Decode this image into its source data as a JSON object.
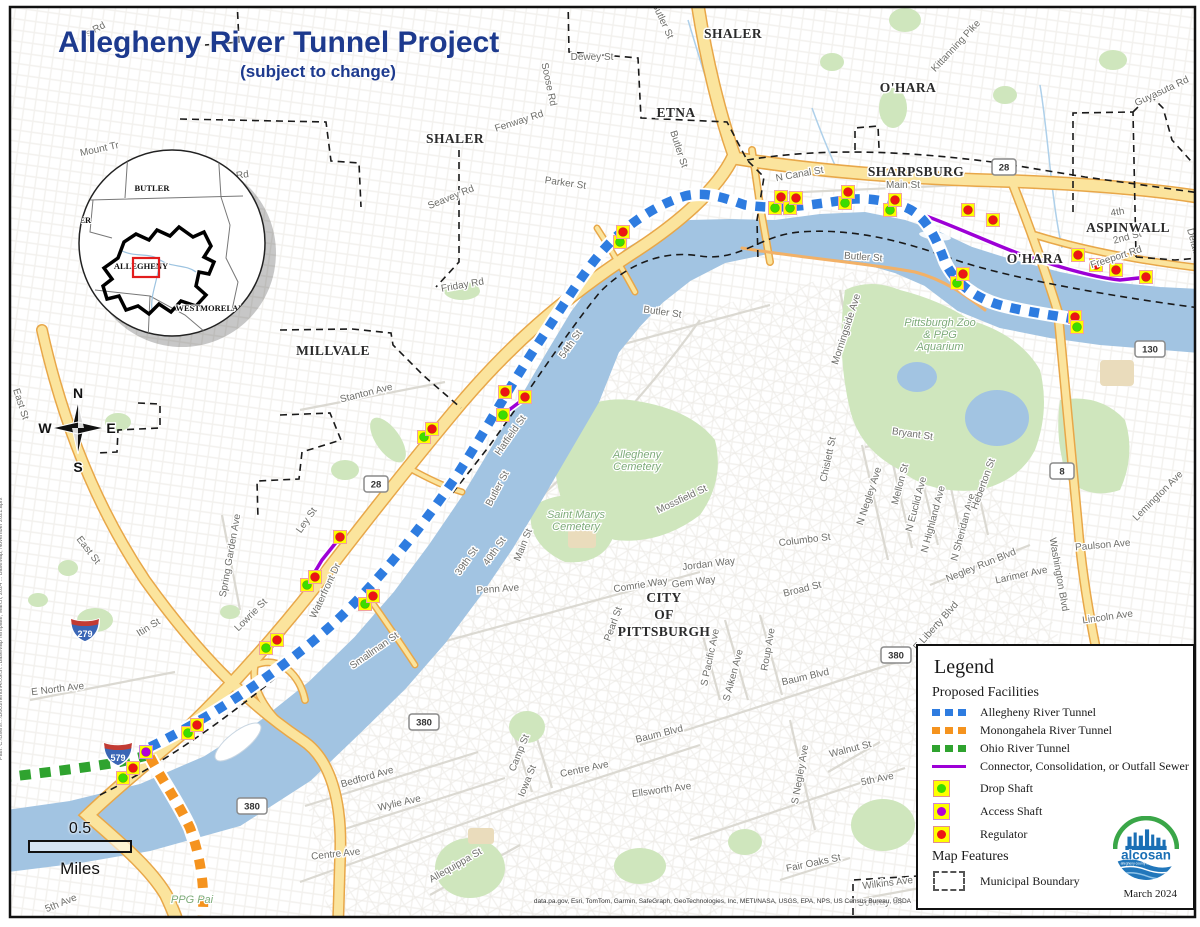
{
  "title": "Allegheny River Tunnel Project",
  "subtitle": "(subject to change)",
  "compass": {
    "north": "N",
    "south": "S",
    "east": "E",
    "west": "W"
  },
  "scale_bar": {
    "value": "0.5",
    "unit": "Miles"
  },
  "attribution": "data.pa.gov, Esri, TomTom, Garmin, SafeGraph, GeoTechnologies, Inc, METI/NASA, USGS, EPA, NPS, US Census Bureau, USDA",
  "source_path_note": "Path: C:\\Users\\...\\Documents\\ArcGIS\\...BaseMap Template, March, 2024 ... BaseMap, November 2021.aprx",
  "legend": {
    "title": "Legend",
    "section_facilities": "Proposed Facilities",
    "section_features": "Map Features",
    "facility_items": [
      {
        "symbol": "dash",
        "color": "#2e7ce0",
        "label": "Allegheny River Tunnel"
      },
      {
        "symbol": "dash",
        "color": "#f5931e",
        "label": "Monongahela River Tunnel"
      },
      {
        "symbol": "dash",
        "color": "#2fa32f",
        "label": "Ohio River Tunnel"
      },
      {
        "symbol": "line",
        "color": "#9d00d6",
        "label": "Connector, Consolidation, or Outfall Sewer"
      },
      {
        "symbol": "square-dot",
        "color": "#3ddc00",
        "label": "Drop Shaft"
      },
      {
        "symbol": "square-dot",
        "color": "#b400d8",
        "label": "Access Shaft"
      },
      {
        "symbol": "square-dot",
        "color": "#ed1515",
        "label": "Regulator"
      }
    ],
    "feature_items": [
      {
        "symbol": "dashed-box",
        "label": "Municipal Boundary"
      }
    ],
    "logo": {
      "name": "alcosan",
      "tagline": "allegheny county sanitary authority"
    },
    "date": "March 2024"
  },
  "inset": {
    "counties": [
      {
        "name": "BUTLER",
        "x": 152,
        "y": 191
      },
      {
        "name": "BEAVER",
        "x": 74,
        "y": 223
      },
      {
        "name": "ALLEGHENY",
        "x": 141,
        "y": 269
      },
      {
        "name": "WESTMORELAND",
        "x": 213,
        "y": 311
      },
      {
        "name": "WASHINGTON",
        "x": 92,
        "y": 339
      }
    ]
  },
  "map": {
    "marker_colors": {
      "d": "#3ddc00",
      "a": "#b400d8",
      "r": "#ed1515"
    },
    "marker_square": "#ffff00",
    "municipalities": [
      {
        "text": "SHALER",
        "x": 733,
        "y": 38
      },
      {
        "text": "SHALER",
        "x": 455,
        "y": 143
      },
      {
        "text": "ETNA",
        "x": 676,
        "y": 117
      },
      {
        "text": "O'HARA",
        "x": 908,
        "y": 92
      },
      {
        "text": "SHARPSBURG",
        "x": 916,
        "y": 176
      },
      {
        "text": "ASPINWALL",
        "x": 1128,
        "y": 232
      },
      {
        "text": "O'HARA",
        "x": 1035,
        "y": 263
      },
      {
        "text": "MILLVALE",
        "x": 333,
        "y": 355
      },
      {
        "lines": [
          "CITY",
          "OF",
          "PITTSBURGH"
        ],
        "x": 664,
        "y": 602
      }
    ],
    "area_labels": [
      {
        "lines": [
          "Allegheny",
          "Cemetery"
        ],
        "x": 637,
        "y": 458
      },
      {
        "lines": [
          "Saint Marys",
          "Cemetery"
        ],
        "x": 576,
        "y": 518
      },
      {
        "lines": [
          "Pittsburgh Zoo",
          "& PPG",
          "Aquarium"
        ],
        "x": 940,
        "y": 326
      },
      {
        "lines": [
          "PPG Pai"
        ],
        "x": 192,
        "y": 903,
        "color": "#8a8a86"
      }
    ],
    "street_labels": [
      {
        "text": "s Rd",
        "x": 97,
        "y": 32,
        "r": -28
      },
      {
        "text": "Mount Tr",
        "x": 100,
        "y": 152,
        "r": -12
      },
      {
        "text": "Geyer Rd",
        "x": 228,
        "y": 180,
        "r": -8
      },
      {
        "text": "Dewey St",
        "x": 592,
        "y": 60,
        "r": 0
      },
      {
        "text": "Soose Rd",
        "x": 546,
        "y": 85,
        "r": 78
      },
      {
        "text": "Fenway Rd",
        "x": 520,
        "y": 124,
        "r": -18
      },
      {
        "text": "Seavey Rd",
        "x": 452,
        "y": 200,
        "r": -22
      },
      {
        "text": "Parker St",
        "x": 565,
        "y": 186,
        "r": 8
      },
      {
        "text": "Friday Rd",
        "x": 463,
        "y": 288,
        "r": -10
      },
      {
        "text": "Butler St",
        "x": 676,
        "y": 150,
        "r": 72
      },
      {
        "text": "Butler St",
        "x": 660,
        "y": 22,
        "r": 65
      },
      {
        "text": "Kittanning Pike",
        "x": 958,
        "y": 48,
        "r": -47
      },
      {
        "text": "Guyasuta Rd",
        "x": 1163,
        "y": 94,
        "r": -25
      },
      {
        "text": "N Canal St",
        "x": 800,
        "y": 177,
        "r": -10
      },
      {
        "text": "Main St",
        "x": 903,
        "y": 188,
        "r": 0
      },
      {
        "text": "Freeport Rd",
        "x": 1117,
        "y": 260,
        "r": -18
      },
      {
        "text": "2nd St",
        "x": 1128,
        "y": 240,
        "r": -15
      },
      {
        "text": "4th",
        "x": 1118,
        "y": 215,
        "r": -10
      },
      {
        "text": "Delafield",
        "x": 1192,
        "y": 248,
        "r": 75
      },
      {
        "text": "Butler St",
        "x": 863,
        "y": 260,
        "r": 4
      },
      {
        "text": "Butler St",
        "x": 662,
        "y": 315,
        "r": 8
      },
      {
        "text": "54th St",
        "x": 573,
        "y": 346,
        "r": -55
      },
      {
        "text": "Morningside Ave",
        "x": 849,
        "y": 330,
        "r": -72
      },
      {
        "text": "Bryant St",
        "x": 912,
        "y": 437,
        "r": 8
      },
      {
        "text": "Chislett St",
        "x": 831,
        "y": 460,
        "r": -78
      },
      {
        "text": "N Negley Ave",
        "x": 872,
        "y": 497,
        "r": -72
      },
      {
        "text": "Mellon St",
        "x": 903,
        "y": 485,
        "r": -75
      },
      {
        "text": "N Euclid Ave",
        "x": 919,
        "y": 505,
        "r": -75
      },
      {
        "text": "N Highland Ave",
        "x": 936,
        "y": 520,
        "r": -75
      },
      {
        "text": "N Sheridan Ave",
        "x": 966,
        "y": 528,
        "r": -75
      },
      {
        "text": "Heberton St",
        "x": 986,
        "y": 485,
        "r": -70
      },
      {
        "text": "Negley Run Blvd",
        "x": 982,
        "y": 568,
        "r": -22
      },
      {
        "text": "Washington Blvd",
        "x": 1056,
        "y": 575,
        "r": 80
      },
      {
        "text": "E Liberty Blvd",
        "x": 938,
        "y": 628,
        "r": -48
      },
      {
        "text": "Larimer Ave",
        "x": 1022,
        "y": 578,
        "r": -12
      },
      {
        "text": "Paulson Ave",
        "x": 1103,
        "y": 548,
        "r": -5
      },
      {
        "text": "Lincoln Ave",
        "x": 1108,
        "y": 620,
        "r": -8
      },
      {
        "text": "Lemington Ave",
        "x": 1160,
        "y": 498,
        "r": -45
      },
      {
        "text": "Stanton Ave",
        "x": 367,
        "y": 396,
        "r": -14
      },
      {
        "text": "Ley St",
        "x": 309,
        "y": 522,
        "r": -55
      },
      {
        "text": "Waterfront Dr",
        "x": 328,
        "y": 592,
        "r": -65
      },
      {
        "text": "Lowrie St",
        "x": 253,
        "y": 617,
        "r": -45
      },
      {
        "text": "Spring Garden Ave",
        "x": 233,
        "y": 556,
        "r": -80
      },
      {
        "text": "Itin St",
        "x": 150,
        "y": 630,
        "r": -32
      },
      {
        "text": "E North Ave",
        "x": 58,
        "y": 692,
        "r": -7
      },
      {
        "text": "East St",
        "x": 18,
        "y": 405,
        "r": 72
      },
      {
        "text": "East St",
        "x": 86,
        "y": 552,
        "r": 52
      },
      {
        "text": "39th St",
        "x": 469,
        "y": 563,
        "r": -55
      },
      {
        "text": "40th St",
        "x": 497,
        "y": 553,
        "r": -55
      },
      {
        "text": "Main St",
        "x": 526,
        "y": 546,
        "r": -68
      },
      {
        "text": "Butler St",
        "x": 500,
        "y": 490,
        "r": -62
      },
      {
        "text": "Hatfield St",
        "x": 513,
        "y": 437,
        "r": -55
      },
      {
        "text": "Penn Ave",
        "x": 498,
        "y": 592,
        "r": -4
      },
      {
        "text": "Smallman St",
        "x": 376,
        "y": 653,
        "r": -35
      },
      {
        "text": "Mossfield St",
        "x": 683,
        "y": 502,
        "r": -25
      },
      {
        "text": "Jordan Way",
        "x": 709,
        "y": 567,
        "r": -7
      },
      {
        "text": "Gem Way",
        "x": 694,
        "y": 585,
        "r": -7
      },
      {
        "text": "Comrie Way",
        "x": 641,
        "y": 588,
        "r": -9
      },
      {
        "text": "Columbo St",
        "x": 805,
        "y": 543,
        "r": -7
      },
      {
        "text": "Broad St",
        "x": 803,
        "y": 592,
        "r": -14
      },
      {
        "text": "Pearl St",
        "x": 616,
        "y": 625,
        "r": -70
      },
      {
        "text": "S Pacific Ave",
        "x": 713,
        "y": 658,
        "r": -78
      },
      {
        "text": "S Aiken Ave",
        "x": 736,
        "y": 676,
        "r": -75
      },
      {
        "text": "Roup Ave",
        "x": 771,
        "y": 650,
        "r": -80
      },
      {
        "text": "Baum Blvd",
        "x": 806,
        "y": 680,
        "r": -13
      },
      {
        "text": "Baum Blvd",
        "x": 660,
        "y": 737,
        "r": -14
      },
      {
        "text": "S Negley Ave",
        "x": 803,
        "y": 775,
        "r": -80
      },
      {
        "text": "Walnut St",
        "x": 851,
        "y": 752,
        "r": -14
      },
      {
        "text": "5th Ave",
        "x": 878,
        "y": 782,
        "r": -12
      },
      {
        "text": "Fair Oaks St",
        "x": 814,
        "y": 866,
        "r": -12
      },
      {
        "text": "Wilkins Ave",
        "x": 888,
        "y": 886,
        "r": -7
      },
      {
        "text": "Solway St",
        "x": 880,
        "y": 905,
        "r": -2
      },
      {
        "text": "Ellsworth Ave",
        "x": 662,
        "y": 793,
        "r": -8
      },
      {
        "text": "Centre Ave",
        "x": 585,
        "y": 772,
        "r": -12
      },
      {
        "text": "Centre Ave",
        "x": 336,
        "y": 857,
        "r": -6
      },
      {
        "text": "Bedford Ave",
        "x": 368,
        "y": 780,
        "r": -16
      },
      {
        "text": "Wylie Ave",
        "x": 400,
        "y": 806,
        "r": -13
      },
      {
        "text": "Camp St",
        "x": 522,
        "y": 754,
        "r": -68
      },
      {
        "text": "Iowa St",
        "x": 530,
        "y": 782,
        "r": -68
      },
      {
        "text": "Allequippa St",
        "x": 457,
        "y": 868,
        "r": -30
      },
      {
        "text": "5th Ave",
        "x": 62,
        "y": 906,
        "r": -22
      }
    ],
    "shields": [
      {
        "type": "interstate",
        "num": "279",
        "x": 85,
        "y": 629
      },
      {
        "type": "interstate",
        "num": "579",
        "x": 118,
        "y": 753
      },
      {
        "type": "route",
        "num": "28",
        "x": 1004,
        "y": 167
      },
      {
        "type": "route",
        "num": "28",
        "x": 376,
        "y": 484
      },
      {
        "type": "route",
        "num": "130",
        "x": 1150,
        "y": 349
      },
      {
        "type": "route",
        "num": "8",
        "x": 1062,
        "y": 471
      },
      {
        "type": "route",
        "num": "380",
        "x": 424,
        "y": 722
      },
      {
        "type": "route",
        "num": "380",
        "x": 896,
        "y": 655
      },
      {
        "type": "route",
        "num": "380",
        "x": 252,
        "y": 806
      }
    ],
    "markers": [
      {
        "t": "d",
        "x": 123,
        "y": 778
      },
      {
        "t": "r",
        "x": 133,
        "y": 768
      },
      {
        "t": "a",
        "x": 146,
        "y": 752
      },
      {
        "t": "d",
        "x": 188,
        "y": 733
      },
      {
        "t": "r",
        "x": 197,
        "y": 725
      },
      {
        "t": "d",
        "x": 266,
        "y": 648
      },
      {
        "t": "r",
        "x": 277,
        "y": 640
      },
      {
        "t": "d",
        "x": 307,
        "y": 585
      },
      {
        "t": "r",
        "x": 315,
        "y": 577
      },
      {
        "t": "d",
        "x": 365,
        "y": 604
      },
      {
        "t": "r",
        "x": 373,
        "y": 596
      },
      {
        "t": "r",
        "x": 340,
        "y": 537
      },
      {
        "t": "d",
        "x": 424,
        "y": 437
      },
      {
        "t": "r",
        "x": 432,
        "y": 429
      },
      {
        "t": "d",
        "x": 503,
        "y": 415
      },
      {
        "t": "r",
        "x": 505,
        "y": 392
      },
      {
        "t": "r",
        "x": 525,
        "y": 397
      },
      {
        "t": "d",
        "x": 620,
        "y": 242
      },
      {
        "t": "r",
        "x": 623,
        "y": 232
      },
      {
        "t": "d",
        "x": 775,
        "y": 208
      },
      {
        "t": "r",
        "x": 781,
        "y": 197
      },
      {
        "t": "d",
        "x": 790,
        "y": 208
      },
      {
        "t": "r",
        "x": 796,
        "y": 198
      },
      {
        "t": "d",
        "x": 845,
        "y": 203
      },
      {
        "t": "r",
        "x": 848,
        "y": 192
      },
      {
        "t": "d",
        "x": 890,
        "y": 210
      },
      {
        "t": "r",
        "x": 895,
        "y": 200
      },
      {
        "t": "r",
        "x": 968,
        "y": 210
      },
      {
        "t": "d",
        "x": 957,
        "y": 283
      },
      {
        "t": "r",
        "x": 963,
        "y": 274
      },
      {
        "t": "r",
        "x": 993,
        "y": 220
      },
      {
        "t": "r",
        "x": 1078,
        "y": 255
      },
      {
        "t": "r",
        "x": 1096,
        "y": 265
      },
      {
        "t": "r",
        "x": 1116,
        "y": 270
      },
      {
        "t": "r",
        "x": 1146,
        "y": 277
      },
      {
        "t": "r",
        "x": 1075,
        "y": 317
      },
      {
        "t": "d",
        "x": 1077,
        "y": 327
      }
    ]
  }
}
